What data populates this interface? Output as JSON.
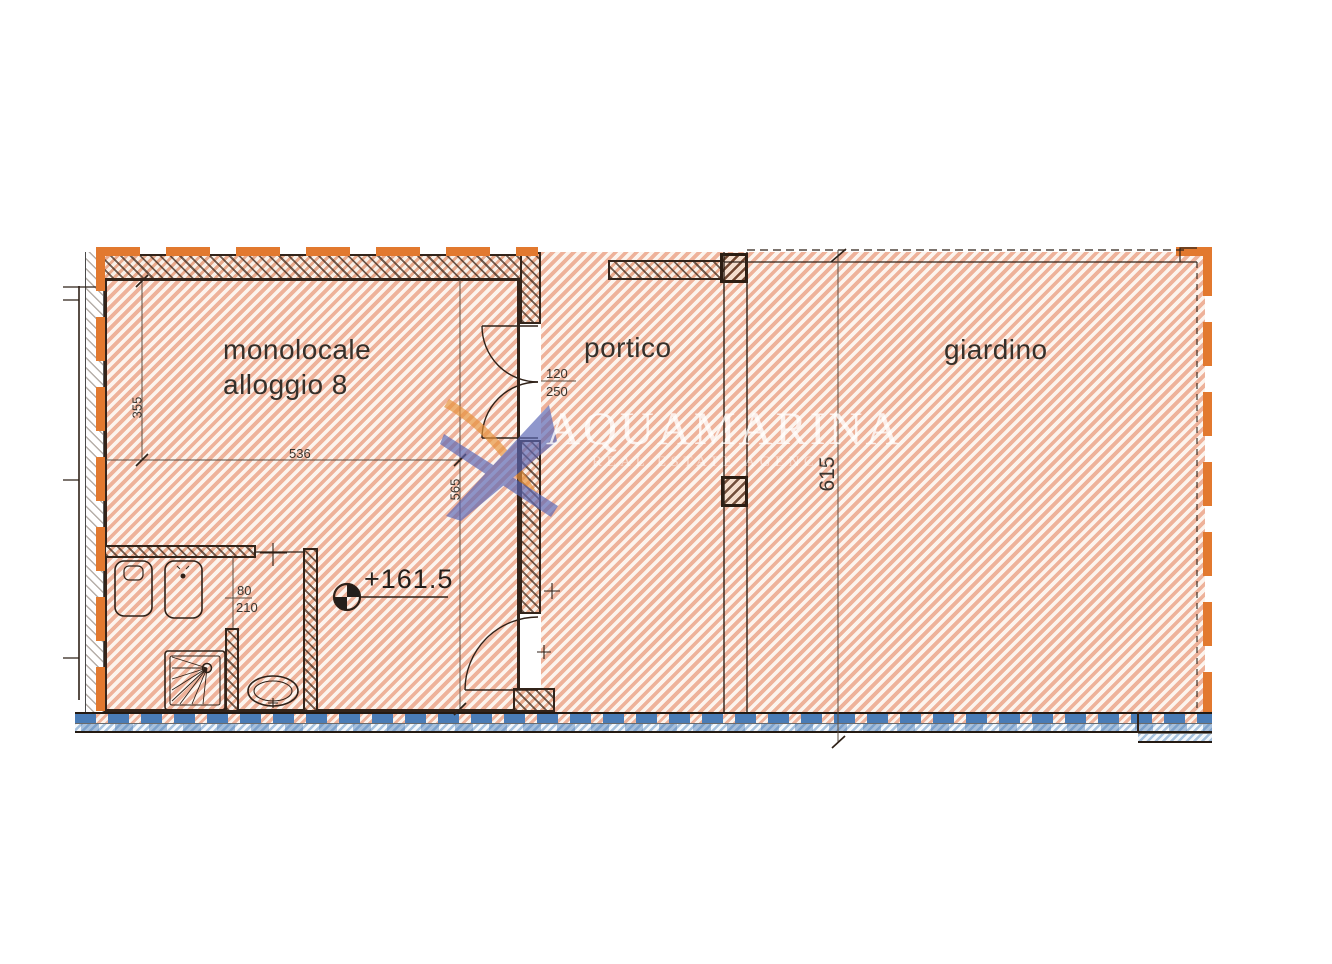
{
  "plan": {
    "rooms": {
      "monolocale": {
        "label": "monolocale\nalloggio 8"
      },
      "portico": {
        "label": "portico"
      },
      "giardino": {
        "label": "giardino"
      }
    },
    "dimensions": {
      "height_355": "355",
      "width_536": "536",
      "height_565": "565",
      "garden_615": "615",
      "door_main_width": "120",
      "door_main_height": "250",
      "door_bath_width": "80",
      "door_bath_height": "210",
      "elevation": "+161.5"
    },
    "watermark": {
      "brand": "AQUAMARINA",
      "tagline": "REAL ESTATE AGENCY"
    },
    "colors": {
      "hatch_salmon": "#eeb29a",
      "boundary_orange": "#e2792f",
      "insulation_blue": "#4a7cb6",
      "wall_dark": "#33241a",
      "logo_blue": "#5b67b5",
      "logo_orange": "#e8933c"
    }
  }
}
